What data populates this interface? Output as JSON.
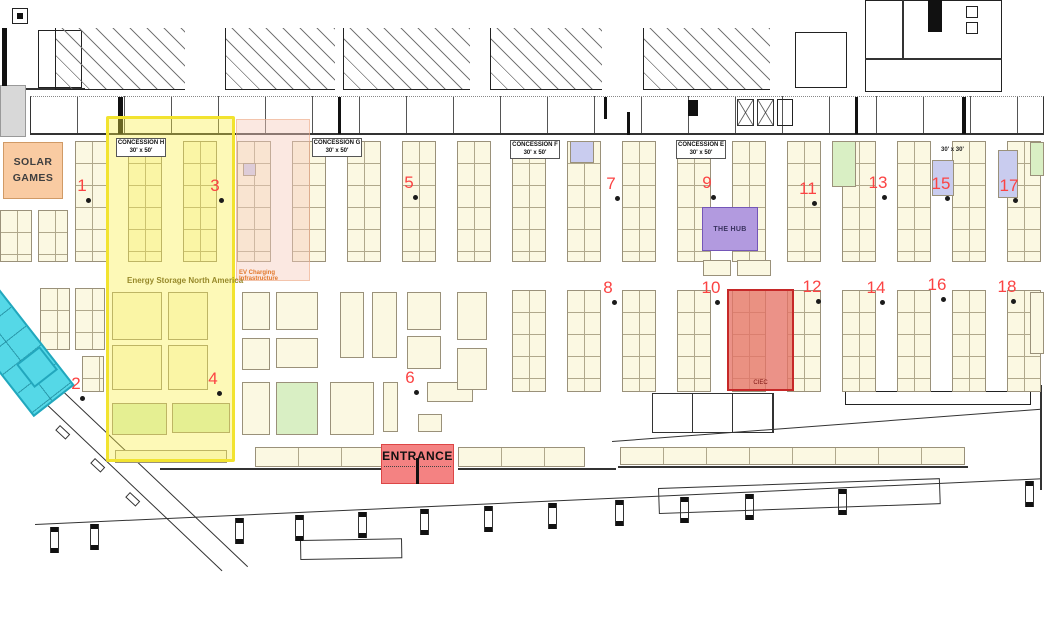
{
  "labels": {
    "solar_games": "SOLAR GAMES",
    "energy_storage": "Energy Storage North America",
    "ev_charging": "EV Charging Infrastructure",
    "the_hub": "THE HUB",
    "ciec": "CIEC",
    "entrance": "ENTRANCE",
    "size_note": "30' x 30'"
  },
  "colors": {
    "booth_fill": "#FBF8E2",
    "booth_green": "#D9EFC4",
    "booth_blue": "#C9CCEF",
    "zone_yellow_border": "#F2E32F",
    "zone_pink": "#F6CDBC",
    "zone_cyan": "#55D8E7",
    "hub_purple": "#B29ADF",
    "ciec_red": "#C62828",
    "entrance_red": "#F48282",
    "solar_orange": "#F9CBA2",
    "marker_red": "#FB4343"
  },
  "concessions": [
    {
      "name": "CONCESSION H",
      "size": "30' x 50'",
      "x": 116,
      "y": 138
    },
    {
      "name": "CONCESSION G",
      "size": "30' x 50'",
      "x": 312,
      "y": 138
    },
    {
      "name": "CONCESSION F",
      "size": "30' x 50'",
      "x": 510,
      "y": 140
    },
    {
      "name": "CONCESSION E",
      "size": "30' x 50'",
      "x": 676,
      "y": 140
    }
  ],
  "markers": [
    {
      "n": "1",
      "x": 82,
      "y": 186
    },
    {
      "n": "2",
      "x": 76,
      "y": 384
    },
    {
      "n": "3",
      "x": 215,
      "y": 186
    },
    {
      "n": "4",
      "x": 213,
      "y": 379
    },
    {
      "n": "5",
      "x": 409,
      "y": 183
    },
    {
      "n": "6",
      "x": 410,
      "y": 378
    },
    {
      "n": "7",
      "x": 611,
      "y": 184
    },
    {
      "n": "8",
      "x": 608,
      "y": 288
    },
    {
      "n": "9",
      "x": 707,
      "y": 183
    },
    {
      "n": "10",
      "x": 711,
      "y": 288
    },
    {
      "n": "11",
      "x": 808,
      "y": 189
    },
    {
      "n": "12",
      "x": 812,
      "y": 287
    },
    {
      "n": "13",
      "x": 878,
      "y": 183
    },
    {
      "n": "14",
      "x": 876,
      "y": 288
    },
    {
      "n": "15",
      "x": 941,
      "y": 184
    },
    {
      "n": "16",
      "x": 937,
      "y": 285
    },
    {
      "n": "17",
      "x": 1009,
      "y": 186
    },
    {
      "n": "18",
      "x": 1007,
      "y": 287
    }
  ],
  "floor": {
    "strips_upper": {
      "y": 141,
      "h": 121,
      "w": 34,
      "xs": [
        75,
        128,
        183,
        237,
        292,
        347,
        402,
        457,
        512,
        567,
        622,
        677,
        732,
        787,
        842,
        897,
        952,
        1007
      ]
    },
    "strips_lower": {
      "y": 290,
      "h": 102,
      "w": 34,
      "xs": [
        512,
        567,
        622,
        677,
        732,
        787,
        842,
        897,
        952,
        1007
      ]
    },
    "strips_extra": [
      [
        0,
        210,
        32,
        52
      ],
      [
        38,
        210,
        30,
        52
      ],
      [
        40,
        288,
        30,
        62
      ],
      [
        75,
        288,
        30,
        62
      ],
      [
        82,
        356,
        22,
        36
      ]
    ],
    "islands": [
      [
        112,
        292,
        50,
        48,
        ""
      ],
      [
        168,
        292,
        40,
        48,
        ""
      ],
      [
        112,
        345,
        50,
        45,
        ""
      ],
      [
        168,
        345,
        40,
        45,
        ""
      ],
      [
        112,
        403,
        55,
        32,
        "green"
      ],
      [
        172,
        403,
        58,
        30,
        "green"
      ],
      [
        115,
        450,
        112,
        13,
        ""
      ],
      [
        242,
        292,
        28,
        38,
        ""
      ],
      [
        276,
        292,
        42,
        38,
        ""
      ],
      [
        340,
        292,
        24,
        66,
        ""
      ],
      [
        372,
        292,
        25,
        66,
        ""
      ],
      [
        407,
        292,
        34,
        38,
        ""
      ],
      [
        242,
        338,
        28,
        32,
        ""
      ],
      [
        276,
        338,
        42,
        30,
        ""
      ],
      [
        407,
        336,
        34,
        33,
        ""
      ],
      [
        242,
        382,
        28,
        53,
        ""
      ],
      [
        276,
        382,
        42,
        53,
        "green"
      ],
      [
        330,
        382,
        44,
        53,
        ""
      ],
      [
        383,
        382,
        15,
        50,
        ""
      ],
      [
        427,
        382,
        46,
        20,
        ""
      ],
      [
        418,
        414,
        24,
        18,
        ""
      ],
      [
        457,
        292,
        30,
        48,
        ""
      ],
      [
        457,
        348,
        30,
        42,
        ""
      ],
      [
        703,
        260,
        28,
        16,
        ""
      ],
      [
        737,
        260,
        34,
        16,
        ""
      ],
      [
        832,
        141,
        24,
        46,
        "green"
      ],
      [
        1030,
        142,
        14,
        34,
        "green"
      ],
      [
        1030,
        292,
        14,
        62,
        ""
      ],
      [
        932,
        160,
        22,
        36,
        "blue"
      ],
      [
        998,
        150,
        20,
        48,
        "blue"
      ],
      [
        570,
        141,
        24,
        22,
        "blue"
      ],
      [
        243,
        163,
        13,
        13,
        "blue"
      ]
    ],
    "bottom_rows": [
      [
        255,
        447,
        128,
        20
      ],
      [
        458,
        447,
        127,
        20
      ],
      [
        620,
        447,
        345,
        18
      ]
    ],
    "columns": [
      [
        50,
        527
      ],
      [
        90,
        524
      ],
      [
        235,
        518
      ],
      [
        295,
        515
      ],
      [
        358,
        512
      ],
      [
        420,
        509
      ],
      [
        484,
        506
      ],
      [
        548,
        503
      ],
      [
        615,
        500
      ],
      [
        680,
        497
      ],
      [
        745,
        494
      ],
      [
        838,
        489
      ],
      [
        1025,
        481
      ]
    ]
  }
}
